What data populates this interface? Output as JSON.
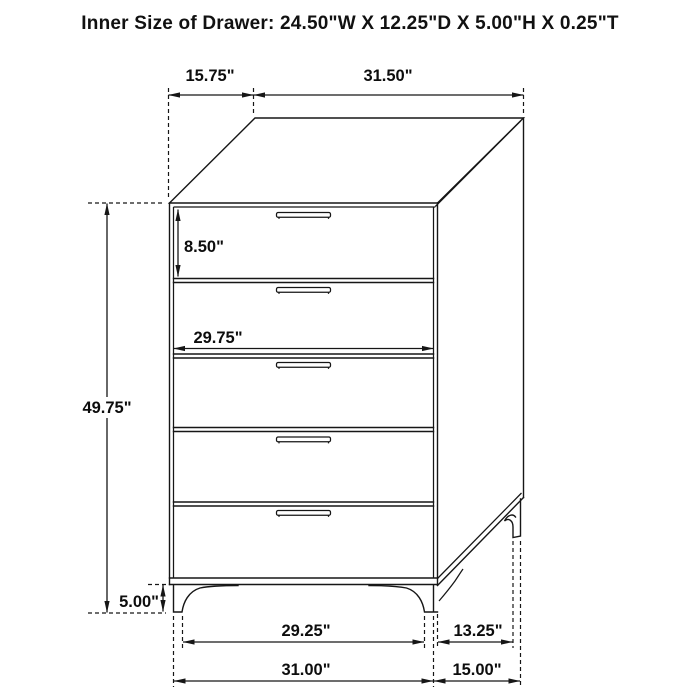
{
  "title": "Inner Size of Drawer: 24.50\"W X 12.25\"D X 5.00\"H X 0.25\"T",
  "furniture": {
    "type": "5-drawer chest technical dimension drawing",
    "drawer_count": 5
  },
  "colors": {
    "background": "#ffffff",
    "line": "#161616",
    "text": "#0d0d0d"
  },
  "dimensions": {
    "top_depth": "15.75\"",
    "top_width": "31.50\"",
    "drawer_front_height": "8.50\"",
    "drawer_width": "29.75\"",
    "total_height": "49.75\"",
    "leg_height": "5.00\"",
    "front_leg_clearance": "29.25\"",
    "side_leg_clearance": "13.25\"",
    "total_width": "31.00\"",
    "total_depth": "15.00\""
  }
}
